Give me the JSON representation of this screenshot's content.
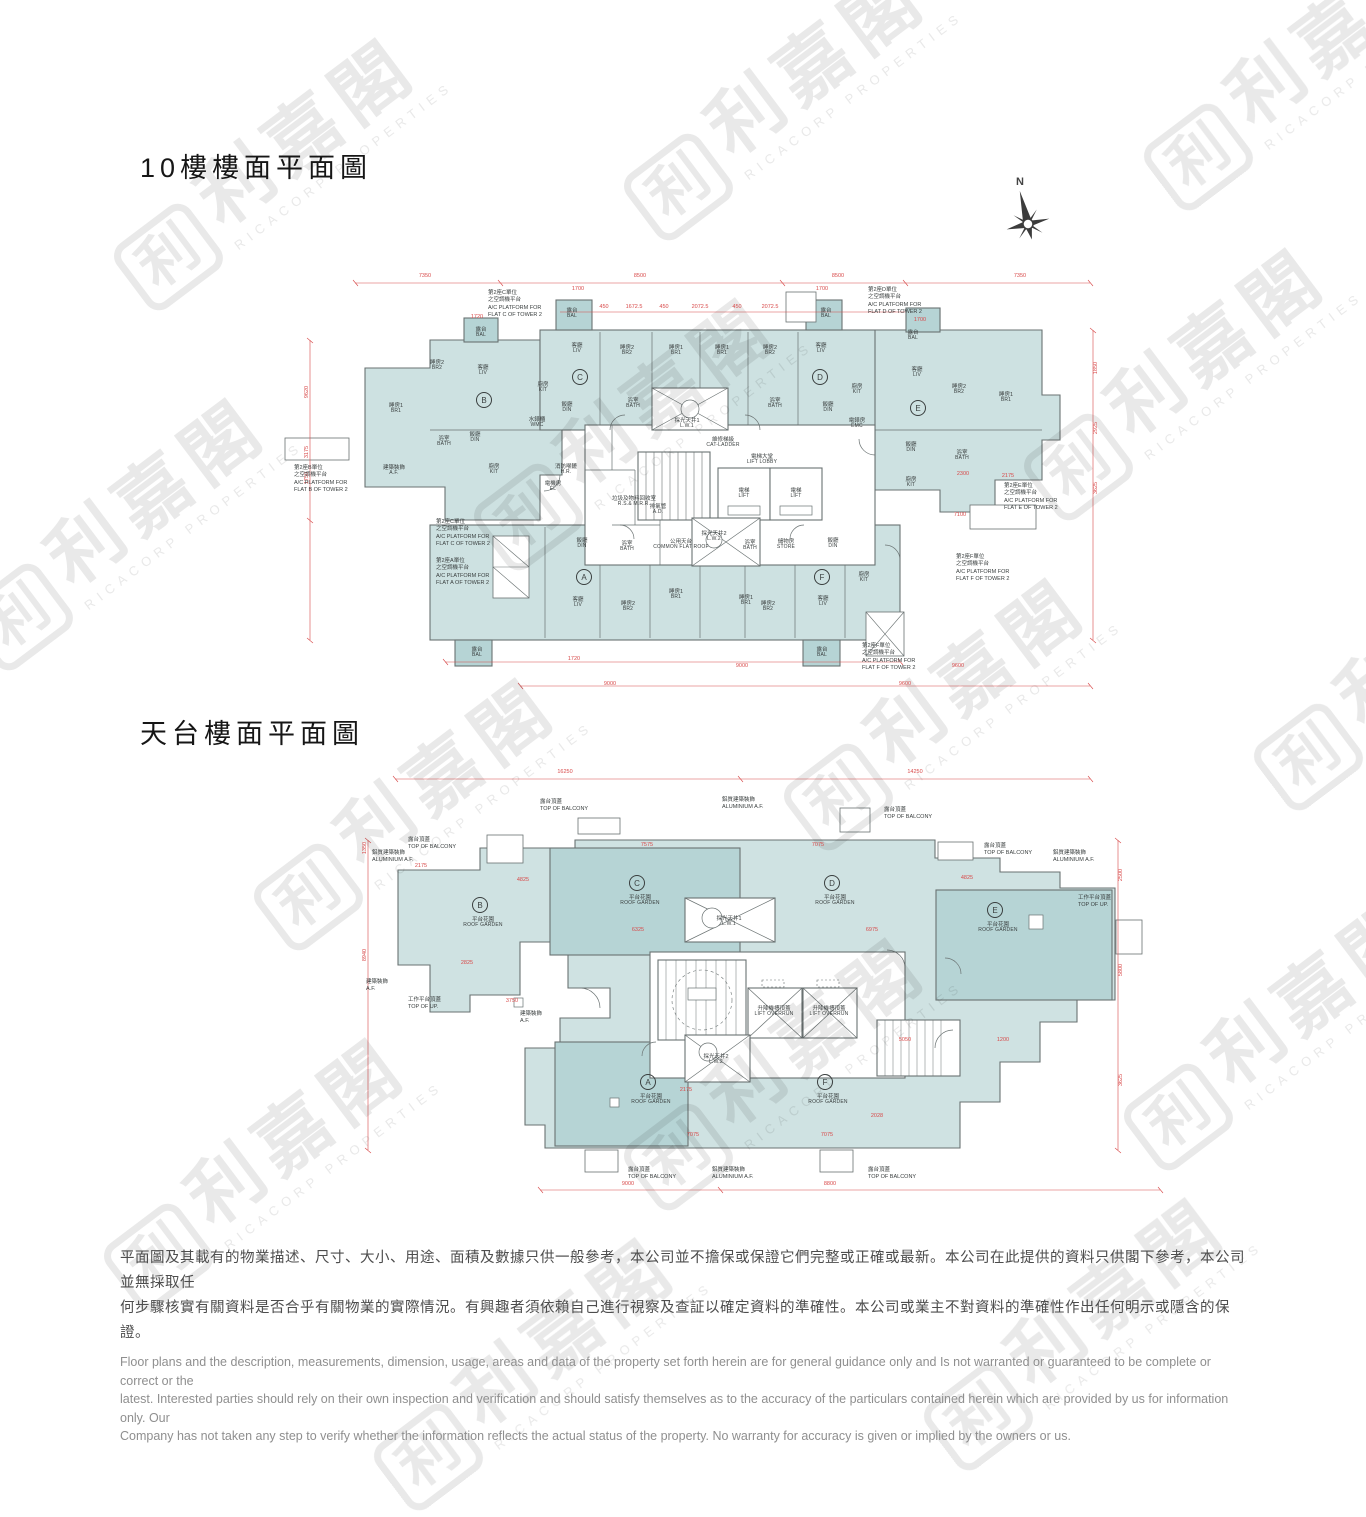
{
  "page": {
    "width": 1366,
    "height": 1366,
    "background": "#ffffff"
  },
  "watermark": {
    "cjk": "利嘉閣",
    "latin": "RICACORP PROPERTIES",
    "logo_glyph": "利",
    "color": "#e9e9e9"
  },
  "colors": {
    "fill_light": "#cde1e1",
    "fill_dark": "#b6d4d5",
    "wall": "#6a7272",
    "dim_red": "#d84a4a",
    "label": "#3a3f3f"
  },
  "titles": {
    "floor10": "10樓樓面平面圖",
    "roof": "天台樓面平面圖"
  },
  "compass": {
    "label": "N"
  },
  "plan_floor10": {
    "flats": [
      {
        "letter": "A",
        "x": 584,
        "y": 577
      },
      {
        "letter": "B",
        "x": 484,
        "y": 400
      },
      {
        "letter": "C",
        "x": 580,
        "y": 377
      },
      {
        "letter": "D",
        "x": 820,
        "y": 377
      },
      {
        "letter": "E",
        "x": 918,
        "y": 408
      },
      {
        "letter": "F",
        "x": 822,
        "y": 577
      }
    ],
    "rooms": [
      {
        "zh": "睡房2",
        "en": "BR2",
        "x": 437,
        "y": 366
      },
      {
        "zh": "客廳",
        "en": "LIV",
        "x": 483,
        "y": 371
      },
      {
        "zh": "睡房1",
        "en": "BR1",
        "x": 396,
        "y": 409
      },
      {
        "zh": "飯廳",
        "en": "DIN",
        "x": 475,
        "y": 438
      },
      {
        "zh": "浴室",
        "en": "BATH",
        "x": 444,
        "y": 442
      },
      {
        "zh": "露台",
        "en": "BAL",
        "x": 481,
        "y": 333
      },
      {
        "zh": "廚房",
        "en": "KIT",
        "x": 494,
        "y": 470
      },
      {
        "zh": "水錶櫃",
        "en": "WMC",
        "x": 537,
        "y": 423
      },
      {
        "zh": "建築裝飾",
        "en": "A.F.",
        "x": 394,
        "y": 471
      },
      {
        "zh": "露台",
        "en": "BAL",
        "x": 572,
        "y": 314
      },
      {
        "zh": "客廳",
        "en": "LIV",
        "x": 577,
        "y": 349
      },
      {
        "zh": "睡房2",
        "en": "BR2",
        "x": 627,
        "y": 351
      },
      {
        "zh": "睡房1",
        "en": "BR1",
        "x": 676,
        "y": 351
      },
      {
        "zh": "廚房",
        "en": "KIT",
        "x": 543,
        "y": 388
      },
      {
        "zh": "飯廳",
        "en": "DIN",
        "x": 567,
        "y": 408
      },
      {
        "zh": "浴室",
        "en": "BATH",
        "x": 633,
        "y": 404
      },
      {
        "zh": "睡房1",
        "en": "BR1",
        "x": 722,
        "y": 351
      },
      {
        "zh": "睡房2",
        "en": "BR2",
        "x": 770,
        "y": 351
      },
      {
        "zh": "客廳",
        "en": "LIV",
        "x": 821,
        "y": 349
      },
      {
        "zh": "露台",
        "en": "BAL",
        "x": 826,
        "y": 314
      },
      {
        "zh": "飯廳",
        "en": "DIN",
        "x": 828,
        "y": 408
      },
      {
        "zh": "廚房",
        "en": "KIT",
        "x": 857,
        "y": 390
      },
      {
        "zh": "浴室",
        "en": "BATH",
        "x": 775,
        "y": 404
      },
      {
        "zh": "露台",
        "en": "BAL",
        "x": 913,
        "y": 336
      },
      {
        "zh": "客廳",
        "en": "LIV",
        "x": 917,
        "y": 373
      },
      {
        "zh": "睡房2",
        "en": "BR2",
        "x": 959,
        "y": 390
      },
      {
        "zh": "睡房1",
        "en": "BR1",
        "x": 1006,
        "y": 398
      },
      {
        "zh": "電錶房",
        "en": "EMC",
        "x": 857,
        "y": 424
      },
      {
        "zh": "飯廳",
        "en": "DIN",
        "x": 911,
        "y": 448
      },
      {
        "zh": "浴室",
        "en": "BATH",
        "x": 962,
        "y": 456
      },
      {
        "zh": "廚房",
        "en": "KIT",
        "x": 911,
        "y": 483
      },
      {
        "zh": "消防喉轆",
        "en": "H.R.",
        "x": 566,
        "y": 470
      },
      {
        "zh": "電機房",
        "en": "EL",
        "x": 553,
        "y": 487
      },
      {
        "zh": "採光天井1",
        "en": "L.W.1",
        "x": 687,
        "y": 424
      },
      {
        "zh": "維修梯級",
        "en": "CAT-LADDER",
        "x": 723,
        "y": 443
      },
      {
        "zh": "電梯大堂",
        "en": "LIFT LOBBY",
        "x": 762,
        "y": 460
      },
      {
        "zh": "電梯",
        "en": "LIFT",
        "x": 744,
        "y": 494
      },
      {
        "zh": "電梯",
        "en": "LIFT",
        "x": 796,
        "y": 494
      },
      {
        "zh": "垃圾及物料回收室",
        "en": "R.S.& M.R.R.",
        "x": 634,
        "y": 502
      },
      {
        "zh": "排氣管",
        "en": "A.D.",
        "x": 658,
        "y": 510
      },
      {
        "zh": "公用天台",
        "en": "COMMON FLAT ROOF",
        "x": 681,
        "y": 545
      },
      {
        "zh": "採光天井2",
        "en": "L.W.2",
        "x": 714,
        "y": 537
      },
      {
        "zh": "浴室",
        "en": "BATH",
        "x": 750,
        "y": 546
      },
      {
        "zh": "儲物房",
        "en": "STORE",
        "x": 786,
        "y": 545
      },
      {
        "zh": "飯廳",
        "en": "DIN",
        "x": 582,
        "y": 544
      },
      {
        "zh": "客廳",
        "en": "LIV",
        "x": 578,
        "y": 603
      },
      {
        "zh": "睡房2",
        "en": "BR2",
        "x": 628,
        "y": 607
      },
      {
        "zh": "睡房1",
        "en": "BR1",
        "x": 676,
        "y": 595
      },
      {
        "zh": "浴室",
        "en": "BATH",
        "x": 627,
        "y": 547
      },
      {
        "zh": "露台",
        "en": "BAL",
        "x": 477,
        "y": 653
      },
      {
        "zh": "睡房1",
        "en": "BR1",
        "x": 746,
        "y": 601
      },
      {
        "zh": "睡房2",
        "en": "BR2",
        "x": 768,
        "y": 607
      },
      {
        "zh": "客廳",
        "en": "LIV",
        "x": 823,
        "y": 602
      },
      {
        "zh": "飯廳",
        "en": "DIN",
        "x": 833,
        "y": 544
      },
      {
        "zh": "廚房",
        "en": "KIT",
        "x": 864,
        "y": 578
      },
      {
        "zh": "露台",
        "en": "BAL",
        "x": 822,
        "y": 653
      }
    ],
    "callouts": [
      {
        "lines": [
          "第2座C單位",
          "之空調機平台",
          "A/C PLATFORM FOR",
          "FLAT C OF TOWER 2"
        ],
        "x": 488,
        "y": 290
      },
      {
        "lines": [
          "第2座D單位",
          "之空調機平台",
          "A/C PLATFORM FOR",
          "FLAT D OF TOWER 2"
        ],
        "x": 868,
        "y": 287
      },
      {
        "lines": [
          "第2座B單位",
          "之空調機平台",
          "A/C PLATFORM FOR",
          "FLAT B OF TOWER 2"
        ],
        "x": 294,
        "y": 465
      },
      {
        "lines": [
          "第2座C單位",
          "之空調機平台",
          "A/C PLATFORM FOR",
          "FLAT C OF TOWER 2"
        ],
        "x": 436,
        "y": 519
      },
      {
        "lines": [
          "第2座A單位",
          "之空調機平台",
          "A/C PLATFORM FOR",
          "FLAT A OF TOWER 2"
        ],
        "x": 436,
        "y": 558
      },
      {
        "lines": [
          "第2座E單位",
          "之空調機平台",
          "A/C PLATFORM FOR",
          "FLAT E OF TOWER 2"
        ],
        "x": 1004,
        "y": 483
      },
      {
        "lines": [
          "第2座F單位",
          "之空調機平台",
          "A/C PLATFORM FOR",
          "FLAT F OF TOWER 2"
        ],
        "x": 956,
        "y": 554
      },
      {
        "lines": [
          "第2座F單位",
          "之空調機平台",
          "A/C PLATFORM FOR",
          "FLAT F OF TOWER 2"
        ],
        "x": 862,
        "y": 643
      }
    ],
    "dims": [
      {
        "t": "7350",
        "x": 425,
        "y": 276
      },
      {
        "t": "8500",
        "x": 640,
        "y": 276
      },
      {
        "t": "8500",
        "x": 838,
        "y": 276
      },
      {
        "t": "7350",
        "x": 1020,
        "y": 276
      },
      {
        "t": "1700",
        "x": 578,
        "y": 289
      },
      {
        "t": "1700",
        "x": 822,
        "y": 289
      },
      {
        "t": "450",
        "x": 604,
        "y": 307
      },
      {
        "t": "1672.5",
        "x": 634,
        "y": 307
      },
      {
        "t": "450",
        "x": 664,
        "y": 307
      },
      {
        "t": "2072.5",
        "x": 700,
        "y": 307
      },
      {
        "t": "450",
        "x": 737,
        "y": 307
      },
      {
        "t": "2072.5",
        "x": 770,
        "y": 307
      },
      {
        "t": "1720",
        "x": 477,
        "y": 317
      },
      {
        "t": "1700",
        "x": 920,
        "y": 320
      },
      {
        "t": "1720",
        "x": 574,
        "y": 659
      },
      {
        "t": "9000",
        "x": 742,
        "y": 666
      },
      {
        "t": "9600",
        "x": 958,
        "y": 666
      },
      {
        "t": "9000",
        "x": 610,
        "y": 684
      },
      {
        "t": "9600",
        "x": 905,
        "y": 684
      },
      {
        "t": "9620",
        "x": 307,
        "y": 392,
        "rot": true
      },
      {
        "t": "3175",
        "x": 307,
        "y": 452,
        "rot": true
      },
      {
        "t": "1750",
        "x": 307,
        "y": 478,
        "rot": true
      },
      {
        "t": "1850",
        "x": 1096,
        "y": 368,
        "rot": true
      },
      {
        "t": "2925",
        "x": 1096,
        "y": 428,
        "rot": true
      },
      {
        "t": "3625",
        "x": 1096,
        "y": 488,
        "rot": true
      },
      {
        "t": "2300",
        "x": 963,
        "y": 474
      },
      {
        "t": "2175",
        "x": 1008,
        "y": 476
      },
      {
        "t": "7100",
        "x": 960,
        "y": 515
      }
    ]
  },
  "plan_roof": {
    "flats": [
      {
        "letter": "A",
        "x": 648,
        "y": 1082
      },
      {
        "letter": "B",
        "x": 480,
        "y": 905
      },
      {
        "letter": "C",
        "x": 637,
        "y": 883
      },
      {
        "letter": "D",
        "x": 832,
        "y": 883
      },
      {
        "letter": "E",
        "x": 995,
        "y": 910
      },
      {
        "letter": "F",
        "x": 825,
        "y": 1082
      }
    ],
    "rooms": [
      {
        "zh": "平台花園",
        "en": "ROOF GARDEN",
        "x": 483,
        "y": 923
      },
      {
        "zh": "平台花園",
        "en": "ROOF GARDEN",
        "x": 640,
        "y": 901
      },
      {
        "zh": "平台花園",
        "en": "ROOF GARDEN",
        "x": 835,
        "y": 901
      },
      {
        "zh": "平台花園",
        "en": "ROOF GARDEN",
        "x": 998,
        "y": 928
      },
      {
        "zh": "平台花園",
        "en": "ROOF GARDEN",
        "x": 651,
        "y": 1100
      },
      {
        "zh": "平台花園",
        "en": "ROOF GARDEN",
        "x": 828,
        "y": 1100
      },
      {
        "zh": "採光天井1",
        "en": "L.W.1",
        "x": 729,
        "y": 922
      },
      {
        "zh": "採光天井2",
        "en": "L.W.2",
        "x": 716,
        "y": 1060
      },
      {
        "zh": "升降機槽頂蓋",
        "en": "LIFT OVERRUN",
        "x": 774,
        "y": 1012
      },
      {
        "zh": "升降機槽頂蓋",
        "en": "LIFT OVERRUN",
        "x": 829,
        "y": 1012
      }
    ],
    "callouts": [
      {
        "lines": [
          "露台頂蓋",
          "TOP OF BALCONY"
        ],
        "x": 540,
        "y": 799
      },
      {
        "lines": [
          "鋁質建築裝飾",
          "ALUMINIUM A.F."
        ],
        "x": 722,
        "y": 797
      },
      {
        "lines": [
          "露台頂蓋",
          "TOP OF BALCONY"
        ],
        "x": 884,
        "y": 807
      },
      {
        "lines": [
          "露台頂蓋",
          "TOP OF BALCONY"
        ],
        "x": 408,
        "y": 837
      },
      {
        "lines": [
          "鋁質建築裝飾",
          "ALUMINIUM A.F."
        ],
        "x": 372,
        "y": 850
      },
      {
        "lines": [
          "露台頂蓋",
          "TOP OF BALCONY"
        ],
        "x": 984,
        "y": 843
      },
      {
        "lines": [
          "鋁質建築裝飾",
          "ALUMINIUM A.F."
        ],
        "x": 1053,
        "y": 850
      },
      {
        "lines": [
          "工作平台頂蓋",
          "TOP OF UP."
        ],
        "x": 1078,
        "y": 895
      },
      {
        "lines": [
          "建築裝飾",
          "A.F."
        ],
        "x": 366,
        "y": 979
      },
      {
        "lines": [
          "工作平台頂蓋",
          "TOP OF UP."
        ],
        "x": 408,
        "y": 997
      },
      {
        "lines": [
          "建築裝飾",
          "A.F."
        ],
        "x": 520,
        "y": 1011
      },
      {
        "lines": [
          "露台頂蓋",
          "TOP OF BALCONY"
        ],
        "x": 628,
        "y": 1167
      },
      {
        "lines": [
          "鋁質建築裝飾",
          "ALUMINIUM A.F."
        ],
        "x": 712,
        "y": 1167
      },
      {
        "lines": [
          "露台頂蓋",
          "TOP OF BALCONY"
        ],
        "x": 868,
        "y": 1167
      }
    ],
    "dims": [
      {
        "t": "16250",
        "x": 565,
        "y": 772
      },
      {
        "t": "14250",
        "x": 915,
        "y": 772
      },
      {
        "t": "1350",
        "x": 365,
        "y": 848,
        "rot": true
      },
      {
        "t": "8940",
        "x": 365,
        "y": 955,
        "rot": true
      },
      {
        "t": "2500",
        "x": 1121,
        "y": 875,
        "rot": true
      },
      {
        "t": "5800",
        "x": 1121,
        "y": 970,
        "rot": true
      },
      {
        "t": "3625",
        "x": 1121,
        "y": 1080,
        "rot": true
      },
      {
        "t": "9000",
        "x": 628,
        "y": 1184
      },
      {
        "t": "8800",
        "x": 830,
        "y": 1184
      },
      {
        "t": "7575",
        "x": 647,
        "y": 845
      },
      {
        "t": "7075",
        "x": 818,
        "y": 845
      },
      {
        "t": "4825",
        "x": 523,
        "y": 880
      },
      {
        "t": "4825",
        "x": 967,
        "y": 878
      },
      {
        "t": "2175",
        "x": 421,
        "y": 866
      },
      {
        "t": "6325",
        "x": 638,
        "y": 930
      },
      {
        "t": "6975",
        "x": 872,
        "y": 930
      },
      {
        "t": "2825",
        "x": 467,
        "y": 963
      },
      {
        "t": "3750",
        "x": 512,
        "y": 1001
      },
      {
        "t": "5050",
        "x": 905,
        "y": 1040
      },
      {
        "t": "1200",
        "x": 1003,
        "y": 1040
      },
      {
        "t": "7075",
        "x": 693,
        "y": 1135
      },
      {
        "t": "7075",
        "x": 827,
        "y": 1135
      },
      {
        "t": "2028",
        "x": 877,
        "y": 1116
      },
      {
        "t": "2175",
        "x": 686,
        "y": 1090
      }
    ]
  },
  "disclaimer": {
    "zh_lines": [
      "平面圖及其載有的物業描述、尺寸、大小、用途、面積及數據只供一般參考，本公司並不擔保或保證它們完整或正確或最新。本公司在此提供的資料只供閣下參考，本公司並無採取任",
      "何步驟核實有關資料是否合乎有關物業的實際情況。有興趣者須依賴自己進行視察及查証以確定資料的準確性。本公司或業主不對資料的準確性作出任何明示或隱含的保證。"
    ],
    "en_lines": [
      "Floor plans and the description, measurements, dimension, usage, areas and data of the property set forth herein are for general guidance only and Is not warranted or guaranteed to be complete or correct or the",
      "latest.  Interested parties should rely on their own inspection and verification and should satisfy themselves as to the accuracy of the particulars contained herein which are provided by us for information only.  Our",
      "Company has not taken any step to verify whether the information reflects the actual status of the property.  No warranty for accuracy is given or implied by the owners or us."
    ]
  }
}
